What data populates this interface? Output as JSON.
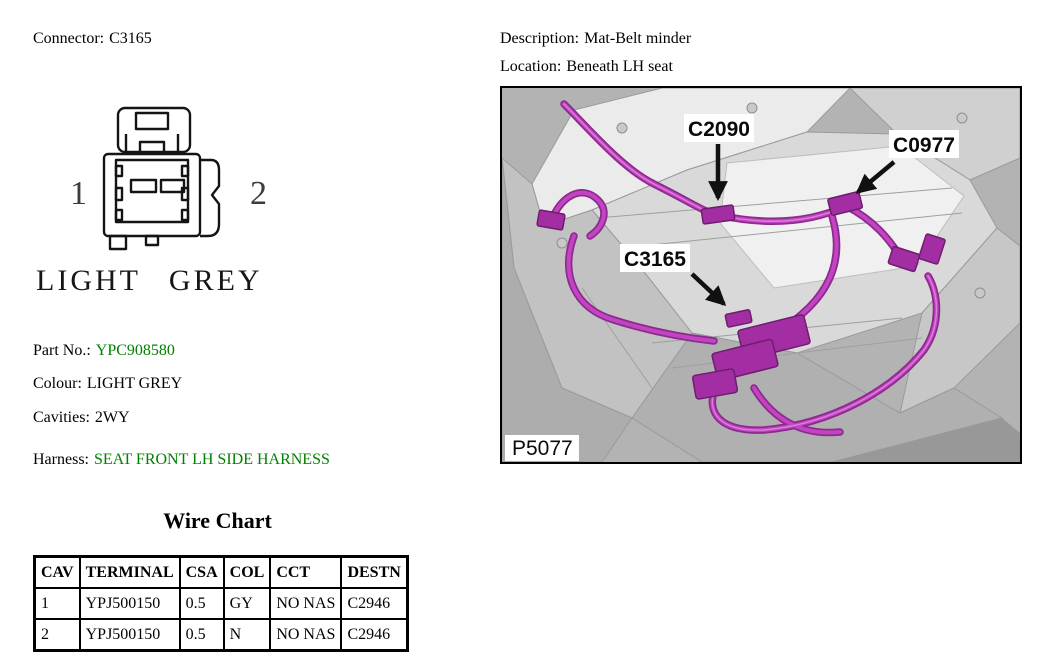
{
  "header": {
    "connector_label": "Connector:",
    "connector_value": "C3165",
    "description_label": "Description:",
    "description_value": "Mat-Belt minder",
    "location_label": "Location:",
    "location_value": "Beneath LH seat"
  },
  "connector_drawing": {
    "pin_left": "1",
    "pin_right": "2",
    "colour_caption": "LIGHT GREY"
  },
  "details": {
    "part_no_label": "Part No.:",
    "part_no_value": "YPC908580",
    "colour_label": "Colour:",
    "colour_value": "LIGHT GREY",
    "cavities_label": "Cavities:",
    "cavities_value": "2WY",
    "harness_label": "Harness:",
    "harness_value": "SEAT FRONT LH SIDE HARNESS"
  },
  "figure": {
    "callouts": [
      "C2090",
      "C0977",
      "C3165"
    ],
    "figure_id": "P5077"
  },
  "wire_chart": {
    "title": "Wire Chart",
    "columns": [
      "CAV",
      "TERMINAL",
      "CSA",
      "COL",
      "CCT",
      "DESTN"
    ],
    "rows": [
      [
        "1",
        "YPJ500150",
        "0.5",
        "GY",
        "NO NAS",
        "C2946"
      ],
      [
        "2",
        "YPJ500150",
        "0.5",
        "N",
        "NO NAS",
        "C2946"
      ]
    ]
  },
  "colors": {
    "link_green": "#008000",
    "harness_magenta": "#b636b6",
    "figure_background": "#b3b3b3"
  }
}
